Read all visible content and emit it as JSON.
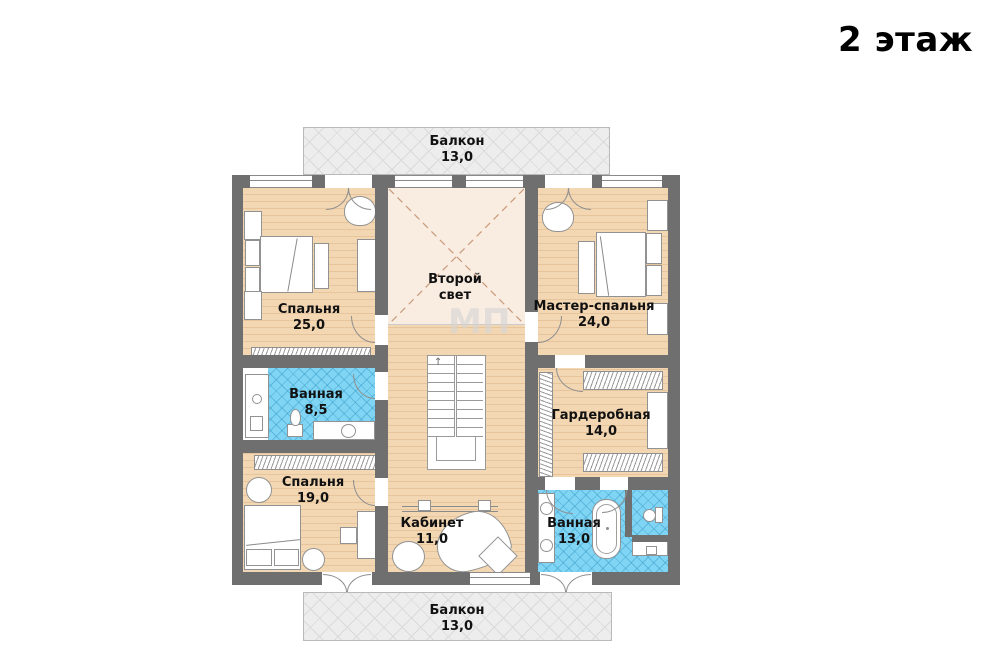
{
  "title": "2 этаж",
  "stairs_arrow": "↑",
  "watermark": "МП",
  "rooms": {
    "balcony_top": {
      "name": "Балкон",
      "area": "13,0"
    },
    "bedroom_25": {
      "name": "Спальня",
      "area": "25,0"
    },
    "second_light": {
      "line1": "Второй",
      "line2": "свет"
    },
    "master_bedroom": {
      "name": "Мастер-спальня",
      "area": "24,0"
    },
    "bathroom_85": {
      "name": "Ванная",
      "area": "8,5"
    },
    "wardrobe": {
      "name": "Гардеробная",
      "area": "14,0"
    },
    "bedroom_19": {
      "name": "Спальня",
      "area": "19,0"
    },
    "office": {
      "name": "Кабинет",
      "area": "11,0"
    },
    "bathroom_13": {
      "name": "Ванная",
      "area": "13,0"
    },
    "balcony_bottom": {
      "name": "Балкон",
      "area": "13,0"
    }
  },
  "colors": {
    "wall": "#6f6f6f",
    "wood_floor": "#f3d7b3",
    "tile_floor": "#80d4f4",
    "void_floor": "#f9ece1",
    "balcony_floor": "#ededed",
    "label_text": "#111111"
  }
}
